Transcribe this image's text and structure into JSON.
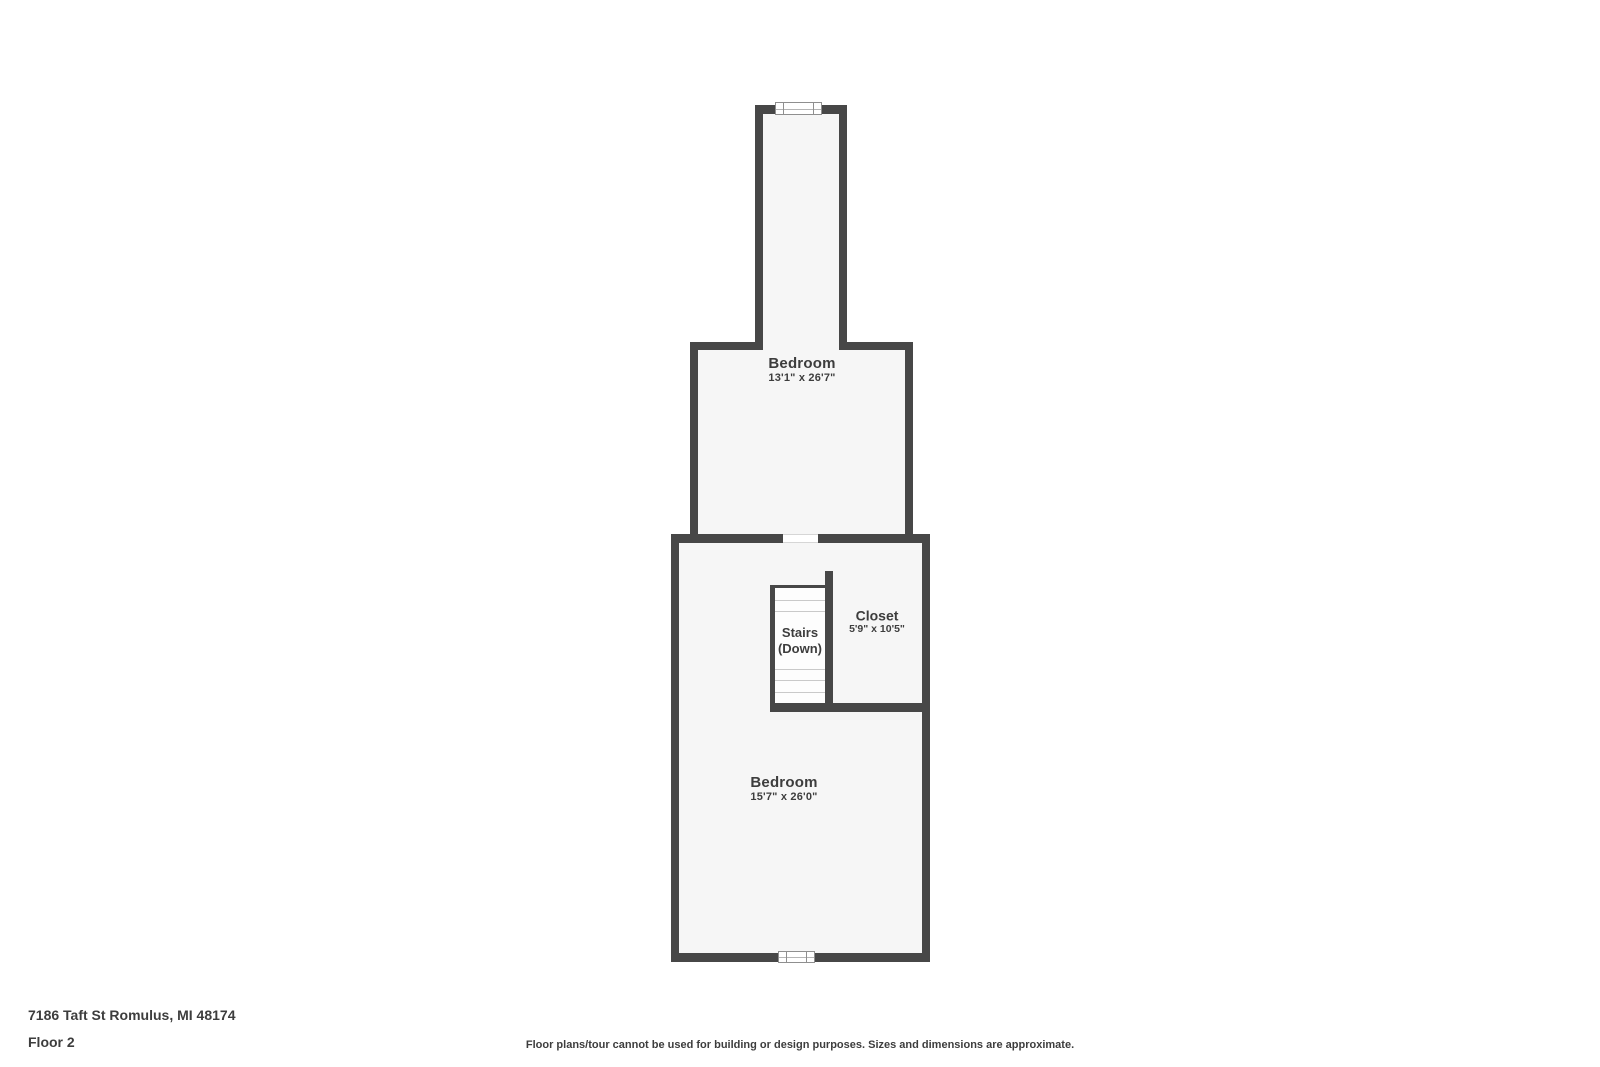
{
  "floorplan": {
    "rooms": {
      "bedroom_top": {
        "name": "Bedroom",
        "dims": "13'1\" x 26'7\""
      },
      "closet": {
        "name": "Closet",
        "dims": "5'9\" x 10'5\""
      },
      "bedroom_bottom": {
        "name": "Bedroom",
        "dims": "15'7\" x 26'0\""
      }
    },
    "stairs": {
      "line1": "Stairs",
      "line2": "(Down)",
      "tread_count": 9
    },
    "features": [
      "window-top",
      "window-bottom",
      "doorway-between-rooms"
    ]
  },
  "footer": {
    "address": "7186 Taft St Romulus, MI 48174",
    "floor": "Floor 2",
    "disclaimer": "Floor plans/tour cannot be used for building or design purposes. Sizes and dimensions are approximate."
  },
  "colors": {
    "wall": "#474747",
    "room_fill": "#f6f6f6",
    "stair_fill": "#fdfdfd",
    "tread_line": "#c9c9c9",
    "text": "#3d3d3d",
    "window_border": "#8f8f8f"
  }
}
